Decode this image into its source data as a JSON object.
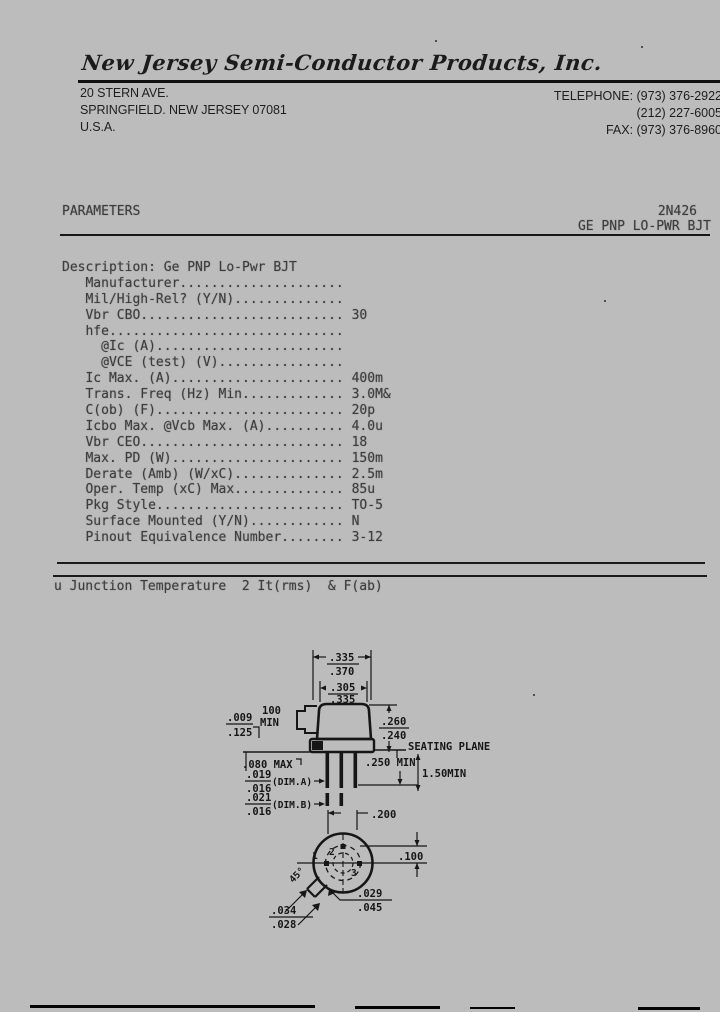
{
  "header": {
    "company": "New Jersey Semi-Conductor Products, Inc.",
    "address": [
      "20 STERN AVE.",
      "SPRINGFIELD. NEW JERSEY 07081",
      "U.S.A."
    ],
    "contact": [
      "TELEPHONE: (973) 376-2922",
      "(212) 227-6005",
      "FAX: (973) 376-8960"
    ]
  },
  "title_block": {
    "section": "PARAMETERS",
    "part_number": "2N426",
    "subtitle": "GE PNP LO-PWR BJT"
  },
  "parameters": {
    "lines": [
      "Description: Ge PNP Lo-Pwr BJT",
      "   Manufacturer.....................",
      "   Mil/High-Rel? (Y/N)..............",
      "   Vbr CBO.......................... 30",
      "   hfe..............................",
      "     @Ic (A)........................",
      "     @VCE (test) (V)................",
      "   Ic Max. (A)...................... 400m",
      "   Trans. Freq (Hz) Min............. 3.0M&",
      "   C(ob) (F)........................ 20p",
      "   Icbo Max. @Vcb Max. (A).......... 4.0u",
      "   Vbr CEO.......................... 18",
      "   Max. PD (W)...................... 150m",
      "   Derate (Amb) (W/xC).............. 2.5m",
      "   Oper. Temp (xC) Max.............. 85u",
      "   Pkg Style........................ TO-5",
      "   Surface Mounted (Y/N)............ N",
      "   Pinout Equivalence Number........ 3-12"
    ]
  },
  "footnote": "u Junction Temperature  2 It(rms)  & F(ab)",
  "drawing": {
    "side_view": {
      "dim_cap_od_top": ".335",
      "dim_cap_od_bottom": ".370",
      "dim_cap_top_top": ".305",
      "dim_cap_top_bottom": ".335",
      "tab_len_1": "100",
      "tab_len_2": "MIN",
      "dim_flange_top": ".009",
      "dim_flange_bottom": ".125",
      "dim_height_top": ".260",
      "dim_height_bottom": ".240",
      "seating_plane": "SEATING PLANE",
      "flange_max": ".080 MAX",
      "lead_straight": ".250 MIN",
      "lead_length": "1.50MIN",
      "dim_a_top": ".019",
      "dim_a_bottom": ".016",
      "dim_a_label": "(DIM.A)",
      "dim_b_top": ".021",
      "dim_b_bottom": ".016",
      "dim_b_label": "(DIM.B)"
    },
    "bottom_view": {
      "lead_circle": ".200",
      "lead_offset": ".100",
      "tab_angle": "45°",
      "tab_width_top": ".029",
      "tab_width_bottom": ".045",
      "tab_len_top": ".034",
      "tab_len_bottom": ".028",
      "pin1": "1",
      "pin2": "2",
      "pin3": "3"
    }
  },
  "colors": {
    "background": "#bcbcbc",
    "ink": "#161616",
    "typewriter": "#3d3d3d"
  }
}
